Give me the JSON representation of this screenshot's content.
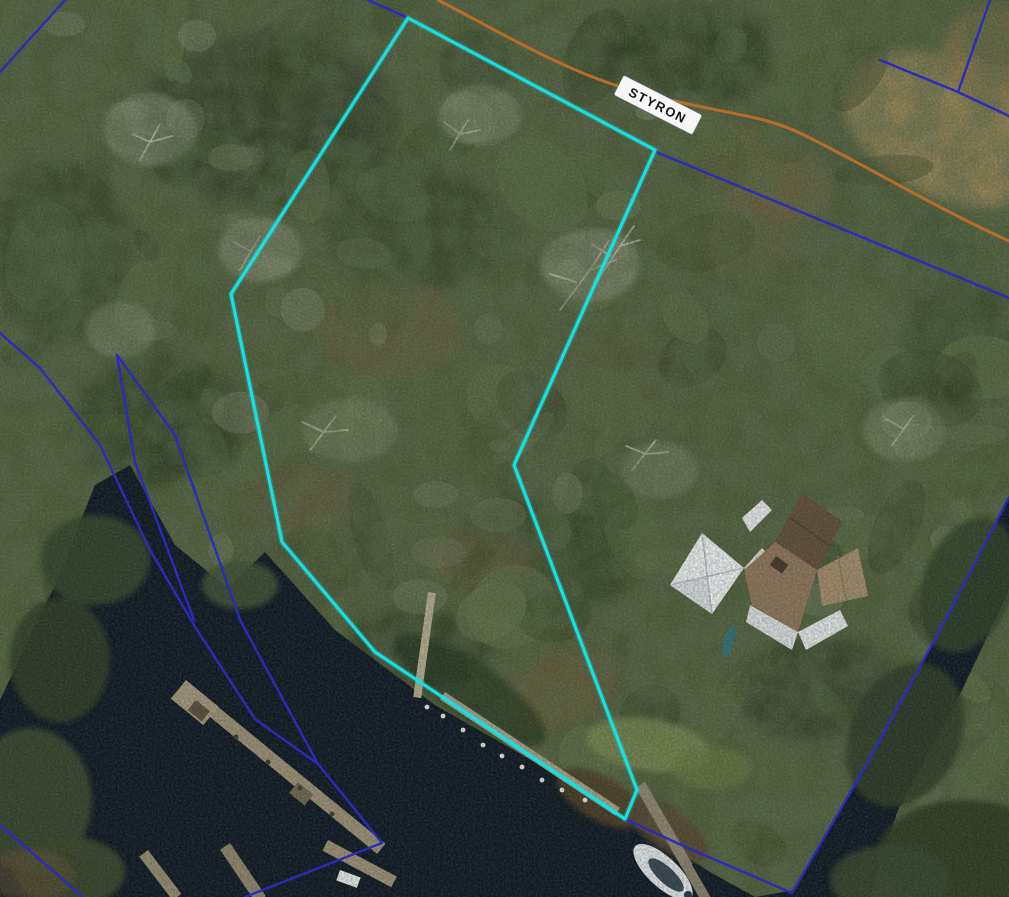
{
  "map": {
    "road_label": "STYRON",
    "colors": {
      "selected_parcel": "#17dfe2",
      "parcel_line": "#2b2bbd",
      "road": "#b76d2c",
      "water": "#0b1320",
      "label_bg": "#f7f7f7",
      "label_text": "#141414"
    },
    "selected_parcel": {
      "points": "408,18 655,150 514,465 637,790 625,819 375,652 282,542 231,294"
    },
    "road": {
      "path": "M438,0 C500,32 570,75 642,93 C725,115 758,113 802,134 C856,160 932,206 1009,241"
    },
    "parcel_lines": [
      {
        "id": "nw-corner-line",
        "points": "65,0 0,72"
      },
      {
        "id": "road-frontage-west",
        "points": "368,0 408,18"
      },
      {
        "id": "road-south-side",
        "points": "656,152 1009,298"
      },
      {
        "id": "road-north-side",
        "points": "880,60 958,92 1009,116"
      },
      {
        "id": "road-north-branch",
        "points": "990,0 958,92"
      },
      {
        "id": "west-waterfront",
        "points": "0,333 40,368 100,445 150,550 197,630 255,719 318,764 382,843 245,897"
      },
      {
        "id": "west-wedge-a",
        "points": "117,355 135,462 194,620"
      },
      {
        "id": "west-wedge-b",
        "points": "117,355 175,435 240,620 318,764"
      },
      {
        "id": "southwest-corner-line",
        "points": "0,825 83,897"
      },
      {
        "id": "east-waterfront",
        "points": "625,819 690,849 792,893 868,762 948,615 1009,497"
      }
    ],
    "label": {
      "x": 658,
      "y": 105,
      "rotation": 27
    }
  }
}
